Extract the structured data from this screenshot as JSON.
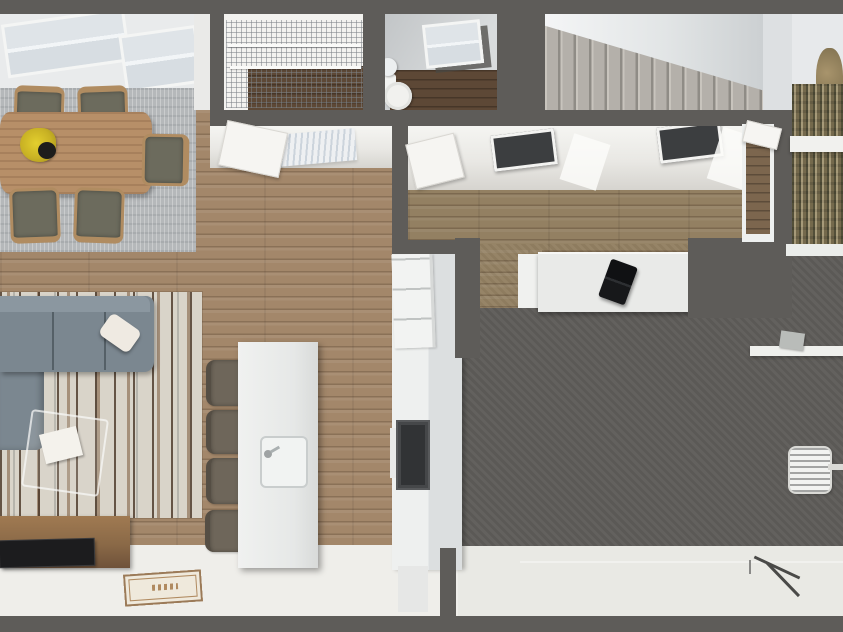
{
  "scene": {
    "type": "3d-floorplan-render",
    "view": "top-down-perspective",
    "visible_text": "none"
  },
  "palette": {
    "wall_dark_gray": "#5e5c59",
    "wood_floor": "#a3876a",
    "hallway_wood": "#938062",
    "bathroom_wood": "#5d4836",
    "dining_rug_gray": "#b5b8ba",
    "striped_rug_cream": "#d9d4c9",
    "rug_stripe_brown": "#7a583a",
    "sofa_gray": "#7b8790",
    "island_white": "#eceded",
    "garage_concrete": "#a2a5a2",
    "garage_apron_white": "#e9e9e4",
    "stair_carpet": "#b4b0aa",
    "ceiling_white": "#f4f5f6",
    "tree_bark": "#87795a",
    "window_glass": "#dfe4e8",
    "appliance_black": "#313335",
    "flowers_yellow": "#d8c32a"
  },
  "rooms": {
    "dining_area": {
      "items": [
        "windows",
        "area-rug",
        "dining-table",
        "flower-centerpiece",
        "dining-chairs x5"
      ]
    },
    "living_room": {
      "items": [
        "striped-rug",
        "sectional-sofa",
        "throw-pillow",
        "glass-coffee-table",
        "magazine",
        "tv-console",
        "tv",
        "doormat"
      ]
    },
    "kitchen": {
      "items": [
        "island",
        "island-sink",
        "bar-stools x4",
        "refrigerator",
        "oven",
        "counter"
      ]
    },
    "closet": {
      "items": [
        "wire-shelving",
        "wood-floor-patch"
      ]
    },
    "bathroom": {
      "items": [
        "skylight-window",
        "toilet",
        "pedestal-sink",
        "dark-wood-floor"
      ]
    },
    "hallway": {
      "items": [
        "ceiling-skylights x2",
        "wall-vent",
        "open-door-leafs x2",
        "desk",
        "laptop"
      ]
    },
    "staircase": {
      "items": [
        "carpeted-steps",
        "sloped-ceiling"
      ]
    },
    "garage": {
      "items": [
        "concrete-floor",
        "white-apron",
        "wall-shelf",
        "shelf-item",
        "snow-shovel",
        "garden-shears"
      ]
    },
    "exterior": {
      "items": [
        "tree",
        "deck-rail",
        "entry-door-opening"
      ]
    }
  }
}
